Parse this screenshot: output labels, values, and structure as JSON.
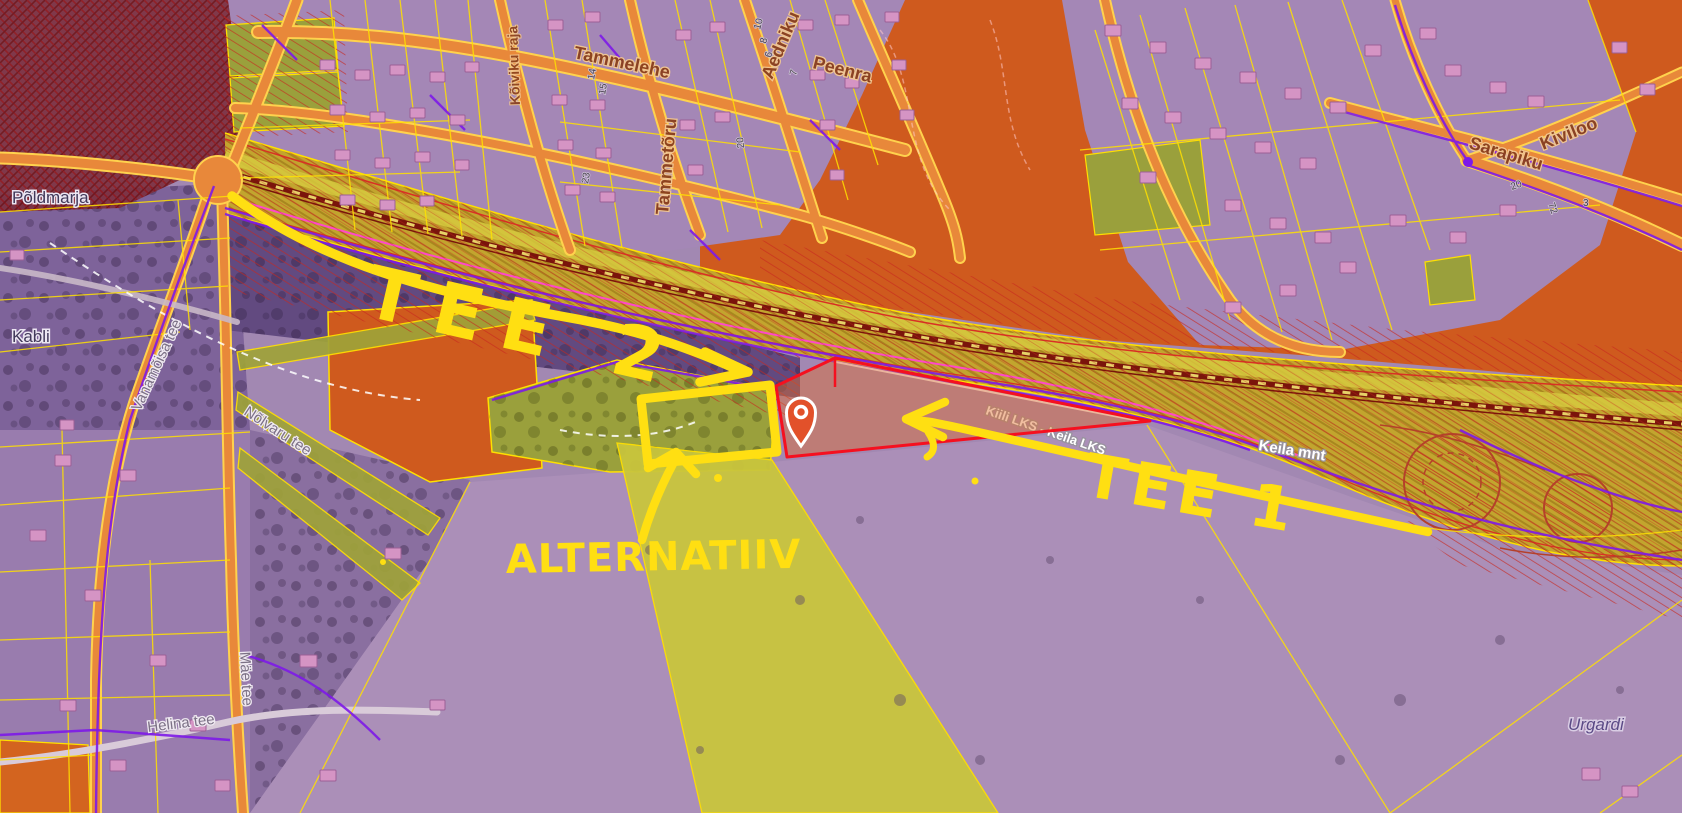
{
  "annotations": {
    "ink_color": "#ffdf12",
    "route1": {
      "label": "TEE 1"
    },
    "route2": {
      "label": "TEE 2"
    },
    "alternative": {
      "label": "ALTERNATIIV"
    }
  },
  "marker": {
    "type": "location-pin",
    "fill": "#e2512a",
    "outline": "#ffffff"
  },
  "site": {
    "outline_color": "#f5101f",
    "alternative_outline_color": "#ffdf12"
  },
  "map": {
    "place_labels": {
      "poldmarja": "Põldmarja",
      "kabli": "Kabli",
      "urgardi": "Urgardi"
    },
    "street_labels": {
      "tammelehe": "Tammelehe",
      "tammetoru": "Tammetõru",
      "aedniku": "Aedniku",
      "peenra": "Peenra",
      "koiviku_raja": "Kõiviku raja",
      "sarapiku": "Sarapiku",
      "kiviloo": "Kiviloo",
      "nolvaru_tee": "Nõlvaru tee",
      "vanamoisa_tee": "Vanamõisa tee",
      "mae_tee": "Mäe tee",
      "helina_tee": "Helina tee"
    },
    "utility_labels": {
      "pipeline": "Kiili LKS - Keila LKS",
      "highway": "Keila mnt"
    },
    "parcel_numbers": [
      "14",
      "15",
      "23",
      "20",
      "10",
      "8",
      "6",
      "7",
      "20",
      "72",
      "3"
    ],
    "zone_colors": {
      "residential_purple": "#a487b6",
      "industrial_orange": "#cf5a1e",
      "field_olive": "#a8a23a",
      "corridor_yellow": "#c2a52e",
      "hatch_red": "#d03024",
      "parcel_line_yellow": "#ffe000",
      "utility_purple": "#7d1ae8",
      "road_orange": "#e8883a"
    }
  }
}
